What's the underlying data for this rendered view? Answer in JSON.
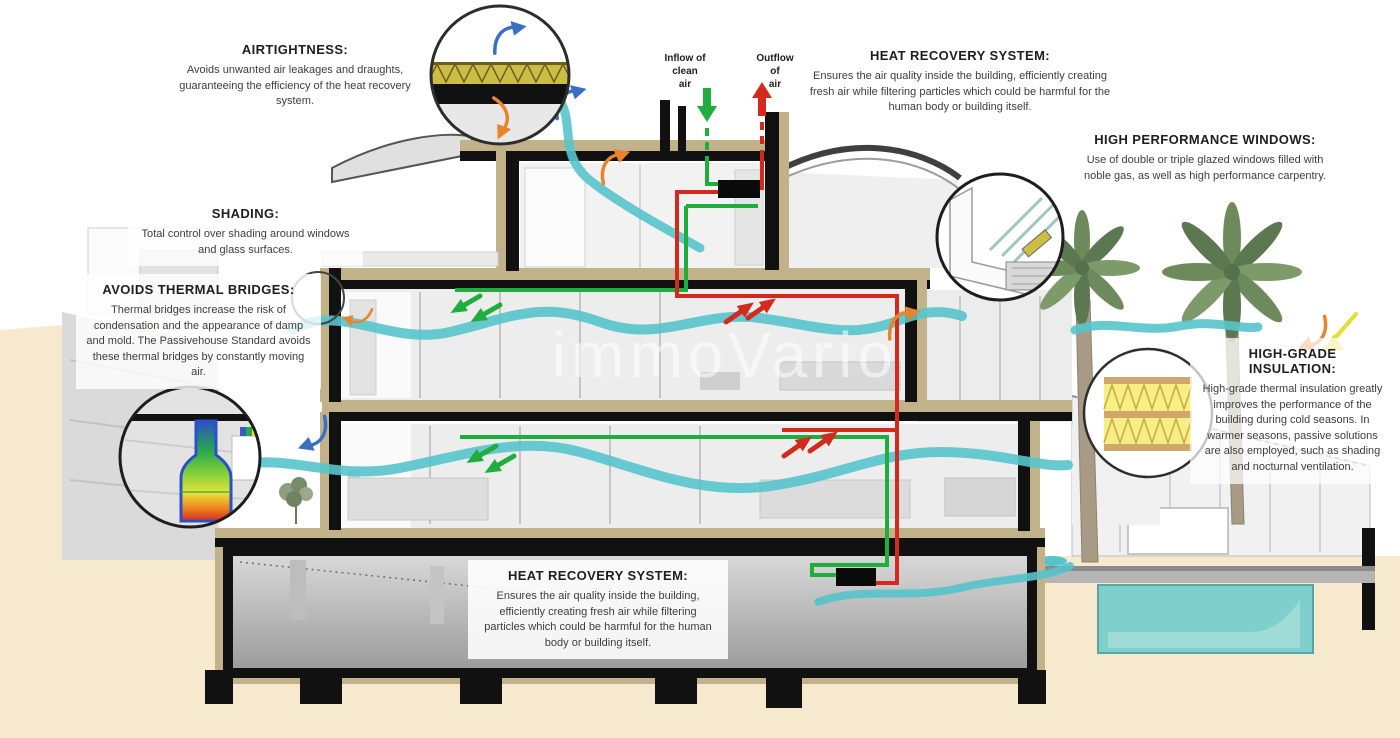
{
  "watermark": {
    "text": "immoVario"
  },
  "flow": {
    "inflow": "Inflow of\nclean\nair",
    "outflow": "Outflow\nof\nair"
  },
  "callouts": {
    "airtightness": {
      "title": "AIRTIGHTNESS:",
      "body": "Avoids unwanted air leakages and draughts, guaranteeing the efficiency of the heat recovery system."
    },
    "heat_recovery_top": {
      "title": "HEAT RECOVERY SYSTEM:",
      "body": "Ensures the air quality inside the building, efficiently creating fresh air while filtering particles which could be harmful for the human body or building itself."
    },
    "high_performance_windows": {
      "title": "HIGH PERFORMANCE WINDOWS:",
      "body": "Use of double or triple glazed windows filled with noble gas, as well as high performance carpentry."
    },
    "shading": {
      "title": "SHADING:",
      "body": "Total control over shading around windows and glass surfaces."
    },
    "avoids_thermal_bridges": {
      "title": "AVOIDS THERMAL BRIDGES:",
      "body": "Thermal bridges increase the risk of condensation and the appearance of damp and mold. The Passivehouse Standard avoids these thermal bridges by constantly moving air."
    },
    "high_grade_insulation": {
      "title": "HIGH-GRADE\nINSULATION:",
      "body": "High-grade thermal insulation greatly improves the performance of the building during cold seasons. In warmer seasons, passive solutions are also employed, such as shading and nocturnal ventilation."
    },
    "heat_recovery_bottom": {
      "title": "HEAT RECOVERY SYSTEM:",
      "body": "Ensures the air quality inside the building, efficiently creating fresh air while filtering particles which could be harmful for the human body or building itself."
    }
  },
  "colors": {
    "airflow_teal": "#57c4cb",
    "inflow_green": "#1fae3e",
    "outflow_red": "#d42a1e",
    "wall_tan": "#c2b289",
    "ground_beige": "#f6e9cd",
    "insulation_yellow": "#f6ef86",
    "pool_teal": "#7fd0cc"
  }
}
